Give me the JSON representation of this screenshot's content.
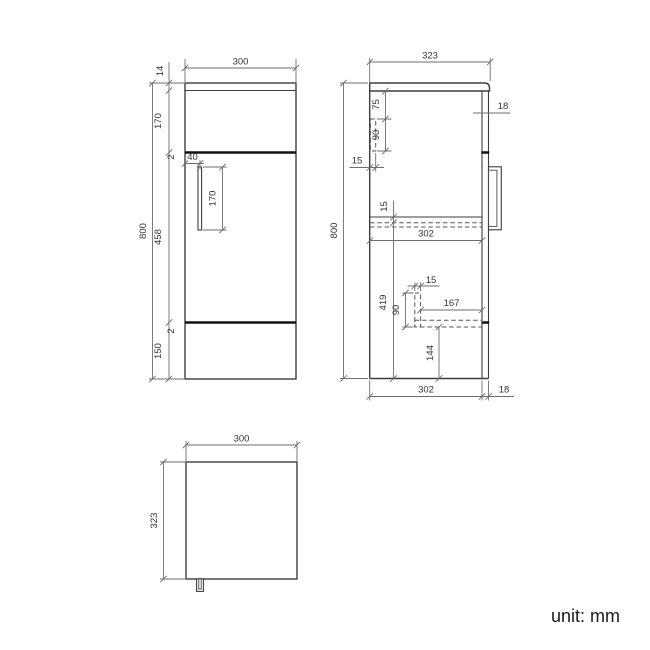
{
  "note": {
    "unit": "unit: mm"
  },
  "colors": {
    "outline": "#3e3e3e",
    "gap_line": "#121212",
    "dimension": "#6e6e6e",
    "label": "#333333",
    "background": "#ffffff"
  },
  "views": {
    "front": {
      "dim_width": "300",
      "dim_worktop_thickness": "14",
      "dim_top_panel_height": "170",
      "dim_gap_top": "2",
      "dim_door_height": "458",
      "dim_gap_bottom": "2",
      "dim_plinth_height": "150",
      "dim_overall_height": "800",
      "dim_handle_inset": "40",
      "dim_handle_length": "170"
    },
    "side": {
      "dim_overall_depth": "323",
      "dim_door_thickness_top": "18",
      "dim_overall_height": "800",
      "dim_bracket_drop": "75",
      "dim_bracket_height": "90",
      "dim_bracket_width": "15",
      "dim_shelf_thickness": "15",
      "dim_internal_depth": "302",
      "dim_lower_section_height": "419",
      "dim_support_width": "15",
      "dim_support_height": "90",
      "dim_support_length": "167",
      "dim_bottom_clearance": "144",
      "dim_internal_depth_bottom": "302",
      "dim_door_thickness_bottom": "18"
    },
    "top": {
      "dim_width": "300",
      "dim_depth": "323"
    }
  }
}
